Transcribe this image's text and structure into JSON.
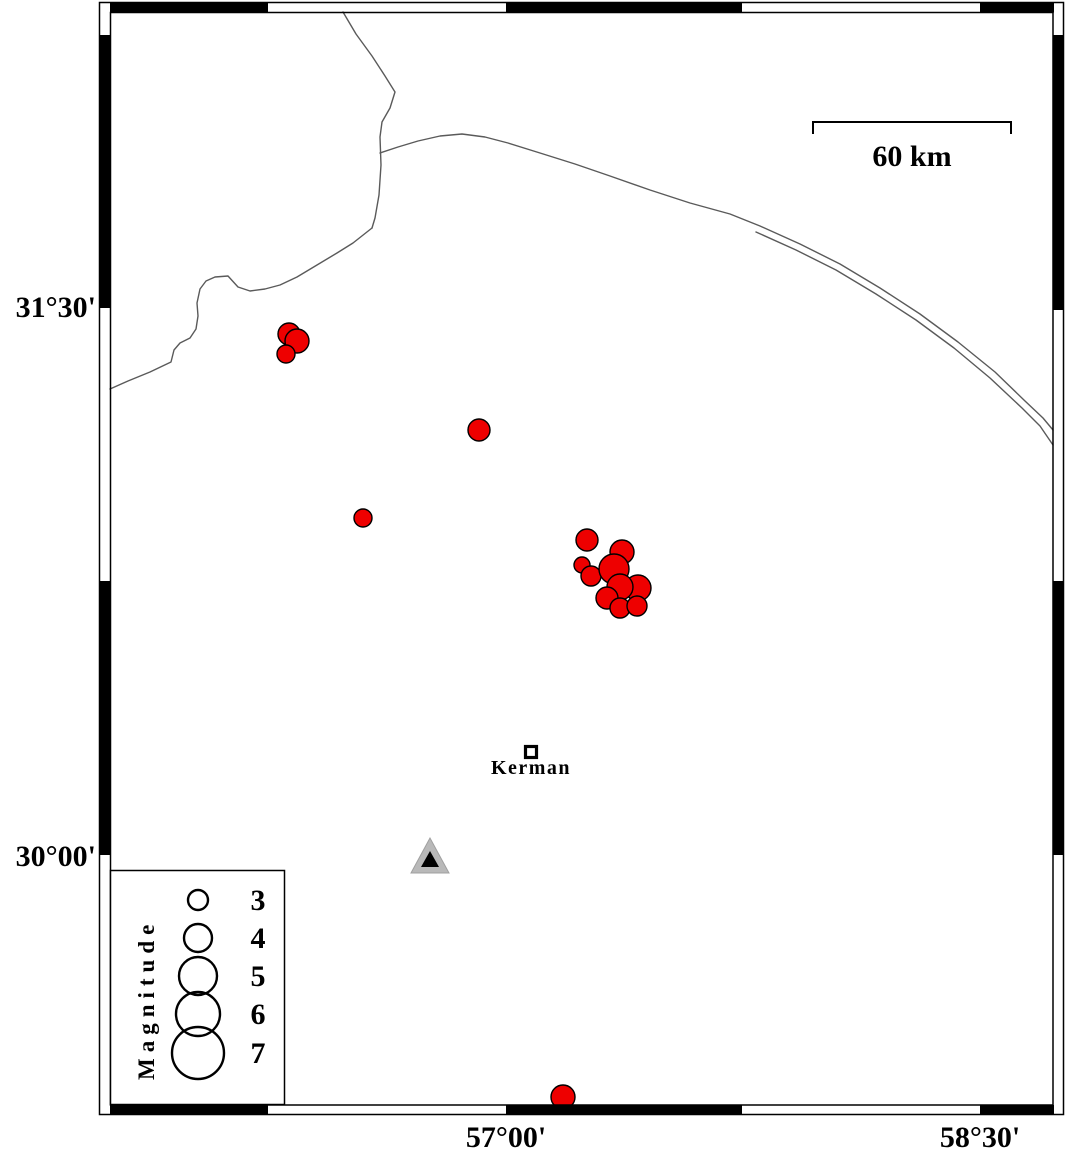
{
  "colors": {
    "earthquake_fill": "#ee0000",
    "marker_outline": "#000000",
    "fault_line": "#5a5a5a",
    "station_fill": "#b9b9b9",
    "station_inner": "#000000",
    "border_black": "#000000",
    "background": "#ffffff"
  },
  "axis": {
    "lat_labels": [
      {
        "text": "31°30'"
      },
      {
        "text": "30°00'"
      }
    ],
    "lon_labels": [
      {
        "text": "57°00'"
      },
      {
        "text": "58°30'"
      }
    ]
  },
  "scale_bar": {
    "label": "60 km"
  },
  "city": {
    "name": "Kerman",
    "x": 531,
    "y": 752
  },
  "station": {
    "x": 430,
    "y": 858
  },
  "legend": {
    "title": "Magnitude",
    "entries": [
      {
        "magnitude": "3",
        "radius": 10
      },
      {
        "magnitude": "4",
        "radius": 14
      },
      {
        "magnitude": "5",
        "radius": 19
      },
      {
        "magnitude": "6",
        "radius": 22
      },
      {
        "magnitude": "7",
        "radius": 26
      }
    ]
  },
  "earthquakes": [
    {
      "x": 289,
      "y": 334,
      "r": 11
    },
    {
      "x": 297,
      "y": 341,
      "r": 12
    },
    {
      "x": 286,
      "y": 354,
      "r": 9
    },
    {
      "x": 479,
      "y": 430,
      "r": 11
    },
    {
      "x": 363,
      "y": 518,
      "r": 9
    },
    {
      "x": 587,
      "y": 540,
      "r": 11
    },
    {
      "x": 582,
      "y": 565,
      "r": 8
    },
    {
      "x": 591,
      "y": 576,
      "r": 10
    },
    {
      "x": 622,
      "y": 552,
      "r": 12
    },
    {
      "x": 614,
      "y": 569,
      "r": 15
    },
    {
      "x": 638,
      "y": 588,
      "r": 13
    },
    {
      "x": 620,
      "y": 587,
      "r": 13
    },
    {
      "x": 607,
      "y": 598,
      "r": 11
    },
    {
      "x": 620,
      "y": 608,
      "r": 10
    },
    {
      "x": 637,
      "y": 606,
      "r": 10
    },
    {
      "x": 563,
      "y": 1097,
      "r": 12
    }
  ],
  "faults": [
    {
      "name": "fault-north",
      "points": [
        [
          343,
          12
        ],
        [
          356,
          34
        ],
        [
          372,
          56
        ],
        [
          385,
          76
        ],
        [
          395,
          92
        ],
        [
          390,
          108
        ],
        [
          382,
          122
        ],
        [
          380,
          137
        ],
        [
          381,
          165
        ],
        [
          379,
          195
        ],
        [
          375,
          218
        ],
        [
          372,
          228
        ]
      ]
    },
    {
      "name": "fault-southwest",
      "points": [
        [
          372,
          228
        ],
        [
          353,
          243
        ],
        [
          337,
          253
        ],
        [
          317,
          265
        ],
        [
          297,
          277
        ],
        [
          280,
          285
        ],
        [
          265,
          289
        ],
        [
          250,
          291
        ],
        [
          238,
          287
        ],
        [
          228,
          276
        ],
        [
          215,
          277
        ],
        [
          206,
          281
        ],
        [
          200,
          289
        ],
        [
          197,
          303
        ],
        [
          198,
          316
        ],
        [
          196,
          329
        ],
        [
          190,
          338
        ],
        [
          180,
          343
        ],
        [
          174,
          350
        ],
        [
          171,
          362
        ],
        [
          150,
          372
        ],
        [
          128,
          381
        ],
        [
          110,
          389
        ]
      ]
    },
    {
      "name": "fault-northeast-arc",
      "points": [
        [
          380,
          153
        ],
        [
          398,
          147
        ],
        [
          418,
          141
        ],
        [
          440,
          136
        ],
        [
          462,
          134
        ],
        [
          485,
          137
        ],
        [
          508,
          143
        ],
        [
          540,
          153
        ],
        [
          575,
          164
        ],
        [
          610,
          176
        ],
        [
          650,
          190
        ],
        [
          690,
          203
        ],
        [
          730,
          214
        ],
        [
          760,
          226
        ],
        [
          800,
          244
        ],
        [
          840,
          264
        ],
        [
          880,
          288
        ],
        [
          920,
          314
        ],
        [
          958,
          342
        ],
        [
          995,
          372
        ],
        [
          1025,
          401
        ],
        [
          1043,
          418
        ],
        [
          1053,
          430
        ]
      ]
    },
    {
      "name": "fault-northeast-arc-parallel",
      "points": [
        [
          756,
          232
        ],
        [
          796,
          250
        ],
        [
          836,
          270
        ],
        [
          876,
          294
        ],
        [
          916,
          320
        ],
        [
          954,
          348
        ],
        [
          990,
          378
        ],
        [
          1022,
          408
        ],
        [
          1040,
          426
        ],
        [
          1053,
          445
        ]
      ]
    }
  ]
}
